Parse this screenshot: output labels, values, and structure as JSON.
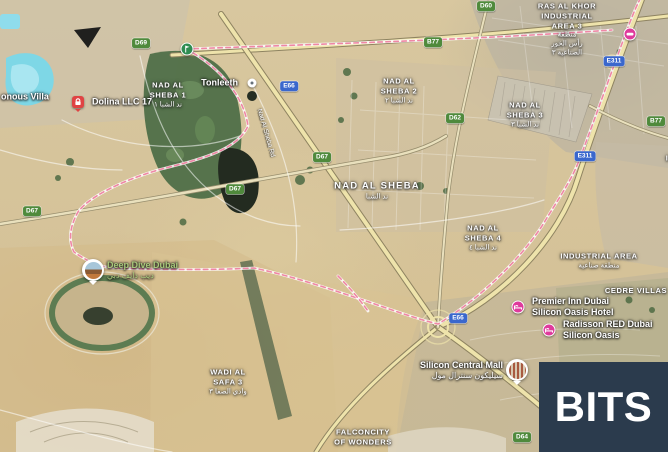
{
  "branding": {
    "logo_text": "BITS"
  },
  "colors": {
    "logo_bg": "#2b3b4d",
    "boundary_pink": "#ef87a5",
    "shield_green": "#4f8a3c",
    "shield_blue": "#3a67cd",
    "hotel_pink": "#df3a9c",
    "poi_green_text": "#a9c97b"
  },
  "map": {
    "view_type": "satellite",
    "district_labels": [
      {
        "id": "nad-al-sheba-1",
        "lines": [
          "NAD AL",
          "SHEBA 1"
        ],
        "arabic": [
          "ند الشبا ١"
        ],
        "x": 168,
        "y": 95
      },
      {
        "id": "nad-al-sheba-2",
        "lines": [
          "NAD AL",
          "SHEBA 2"
        ],
        "arabic": [
          "ند الشبا ٢"
        ],
        "x": 399,
        "y": 91
      },
      {
        "id": "nad-al-sheba-3",
        "lines": [
          "NAD AL",
          "SHEBA 3"
        ],
        "arabic": [
          "ند الشبا ٣"
        ],
        "x": 525,
        "y": 115
      },
      {
        "id": "nad-al-sheba",
        "big": true,
        "lines": [
          "NAD AL SHEBA"
        ],
        "arabic": [
          "ند الشبا"
        ],
        "x": 377,
        "y": 191
      },
      {
        "id": "nad-al-sheba-4",
        "lines": [
          "NAD AL",
          "SHEBA 4"
        ],
        "arabic": [
          "ند الشبا ٤"
        ],
        "x": 483,
        "y": 238
      },
      {
        "id": "ras-al-khor-industrial-area-3",
        "lines": [
          "RAS AL KHOR",
          "INDUSTRIAL",
          "AREA 3"
        ],
        "arabic": [
          "منطقة",
          "رأس الخور",
          "الصناعية ٣"
        ],
        "x": 567,
        "y": 30
      },
      {
        "id": "industrial-area",
        "lines": [
          "INDUSTRIAL AREA"
        ],
        "arabic": [
          "منطقة صناعية"
        ],
        "x": 599,
        "y": 261
      },
      {
        "id": "cedre-villas",
        "lines": [
          "CEDRE VILLAS"
        ],
        "arabic": [],
        "x": 636,
        "y": 291
      },
      {
        "id": "wadi-al-safa-3",
        "lines": [
          "WADI AL",
          "SAFA 3"
        ],
        "arabic": [
          "وادي الصفا ٣"
        ],
        "x": 228,
        "y": 382
      },
      {
        "id": "falconcity-of-wonders",
        "lines": [
          "FALCONCITY",
          "OF WONDERS"
        ],
        "arabic": [],
        "x": 363,
        "y": 437
      },
      {
        "id": "international-city-phase",
        "lines": [
          "INTERNATIONAL",
          "CITY PHASE"
        ],
        "arabic": [],
        "x": 700,
        "y": 163
      }
    ],
    "partial_labels": [
      {
        "id": "villa",
        "text": "onous Villa",
        "x": 1,
        "y": 97
      }
    ],
    "road_name_labels": [
      {
        "id": "nad-al-sheba-rd",
        "text": "Nad Al Sheba Rd",
        "x": 266,
        "y": 133,
        "angle": 74
      }
    ],
    "road_shields": [
      {
        "type": "green",
        "text": "D69",
        "x": 141,
        "y": 43
      },
      {
        "type": "green",
        "text": "B77",
        "x": 433,
        "y": 42
      },
      {
        "type": "green",
        "text": "D60",
        "x": 486,
        "y": 6
      },
      {
        "type": "blue",
        "text": "E66",
        "x": 289,
        "y": 86
      },
      {
        "type": "blue",
        "text": "E311",
        "x": 614,
        "y": 61
      },
      {
        "type": "green",
        "text": "B77",
        "x": 656,
        "y": 121
      },
      {
        "type": "green",
        "text": "D62",
        "x": 455,
        "y": 118
      },
      {
        "type": "blue",
        "text": "E311",
        "x": 585,
        "y": 156
      },
      {
        "type": "green",
        "text": "D67",
        "x": 322,
        "y": 157
      },
      {
        "type": "green",
        "text": "D67",
        "x": 235,
        "y": 189
      },
      {
        "type": "green",
        "text": "D67",
        "x": 32,
        "y": 211
      },
      {
        "type": "blue",
        "text": "E66",
        "x": 458,
        "y": 318
      },
      {
        "type": "green",
        "text": "D64",
        "x": 522,
        "y": 437
      }
    ],
    "pois": [
      {
        "id": "golf-course",
        "marker": "golf",
        "label_lines": [],
        "x": 187,
        "y": 49
      },
      {
        "id": "tonleeth",
        "marker": "dot",
        "label_lines": [
          "Tonleeth"
        ],
        "side": "left",
        "x": 252,
        "y": 83
      },
      {
        "id": "dolina-llc",
        "marker": "red-lock",
        "label_lines": [
          "Dolina LLC 17"
        ],
        "side": "right",
        "x": 78,
        "y": 102
      },
      {
        "id": "metro-station",
        "marker": "metro",
        "label_lines": [],
        "x": 630,
        "y": 34
      },
      {
        "id": "deep-dive-dubai",
        "marker": "photo-deepdive",
        "label_lines": [
          "Deep Dive Dubai"
        ],
        "arabic": "ديب دايف دبي",
        "side": "right",
        "text_color": "green",
        "x": 93,
        "y": 270
      },
      {
        "id": "premier-inn-dubai-silicon-oasis-hotel",
        "marker": "pink-hotel",
        "label_lines": [
          "Premier Inn Dubai",
          "Silicon Oasis Hotel"
        ],
        "side": "right",
        "x": 518,
        "y": 307
      },
      {
        "id": "radisson-red-dubai-silicon-oasis",
        "marker": "pink-hotel",
        "label_lines": [
          "Radisson RED Dubai",
          "Silicon Oasis"
        ],
        "side": "right",
        "x": 549,
        "y": 330
      },
      {
        "id": "silicon-central-mall",
        "marker": "photo-mall",
        "label_lines": [
          "Silicon Central Mall"
        ],
        "arabic": "سيليكون سنترال مول",
        "side": "left",
        "x": 517,
        "y": 370
      }
    ]
  }
}
